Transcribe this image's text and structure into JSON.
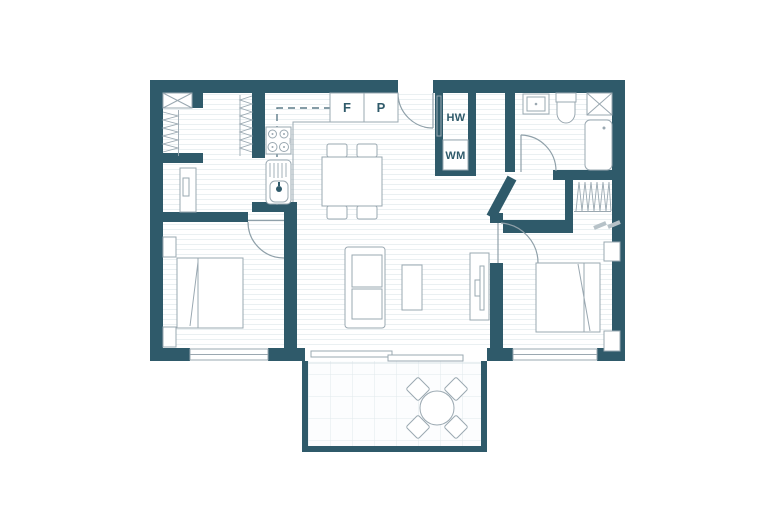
{
  "title": "two-bedroom-apartment-floor-plan",
  "colors": {
    "wall": "#2F5A6A",
    "furniture_outline": "#9AA8B1",
    "floor_stripe": "#EAF0F2",
    "balcony_tile_line": "#E1E9EC",
    "overhead_cabinet_dash": "#5D7B88",
    "label_text": "#2F5A6A",
    "background": "#FFFFFF"
  },
  "labels": {
    "fridge": "F",
    "pantry": "P",
    "hot_water_cylinder": "HW",
    "washing_machine": "WM",
    "stove_width": "600"
  }
}
